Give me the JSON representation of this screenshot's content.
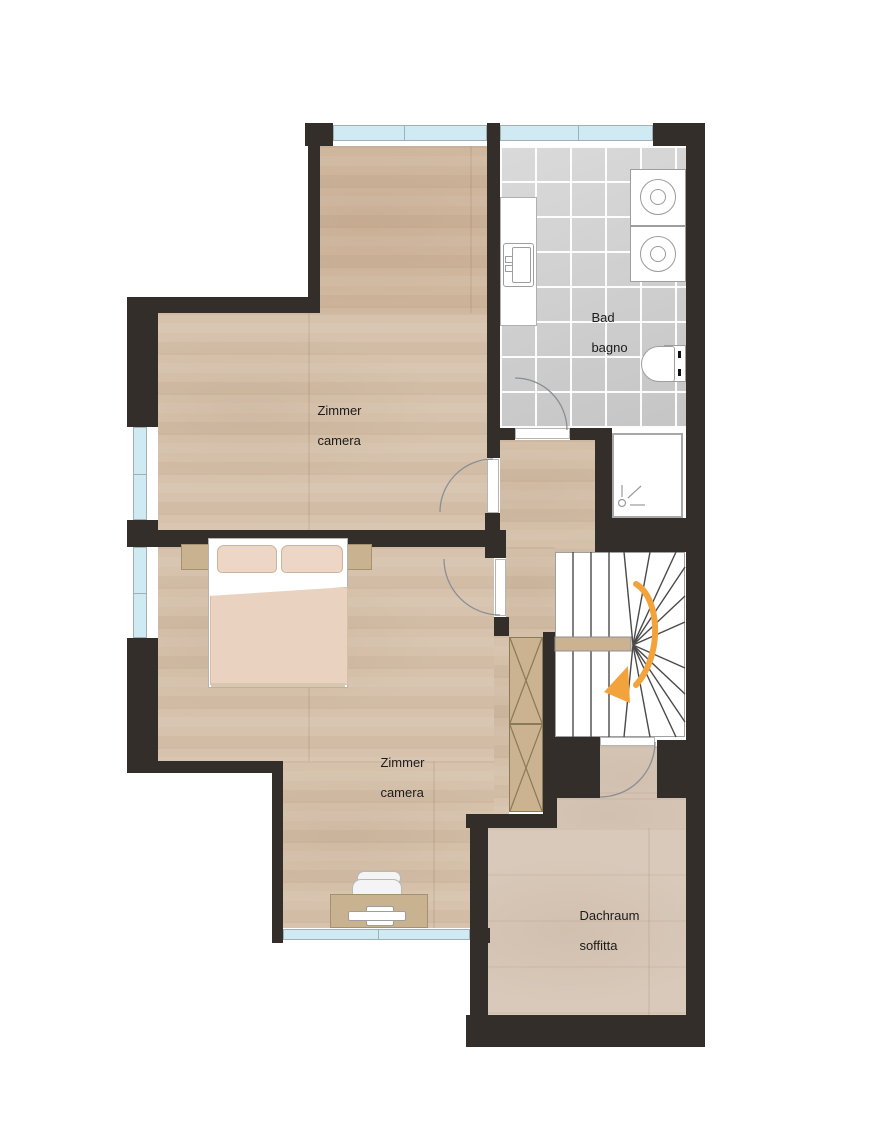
{
  "plan": {
    "type": "floor-plan",
    "floor_labels_bilingual": true
  },
  "rooms": {
    "zimmer1": {
      "line1": "Zimmer",
      "line2": "camera"
    },
    "bad": {
      "line1": "Bad",
      "line2": "bagno"
    },
    "zimmer2": {
      "line1": "Zimmer",
      "line2": "camera"
    },
    "dachraum": {
      "line1": "Dachraum",
      "line2": "soffitta"
    }
  },
  "palette": {
    "wall": "#342e2b",
    "wood_floor": "#d7c3ad",
    "tile_floor": "#cdcdcd",
    "window_glass": "#cfeaf2",
    "stair_arrow_accent": "#f2a33c",
    "furniture_tan": "#c9b28f",
    "bed_textile": "#e9d2c0",
    "label_text": "#1b1b1b"
  },
  "fixtures": {
    "stairs": "winder-staircase",
    "stairs_arrow": "curved-direction-arrow",
    "bath_items": [
      "vanity-sink",
      "washer",
      "washer",
      "toilet",
      "shower"
    ],
    "bedroom_items": [
      "double-bed",
      "nightstand",
      "nightstand",
      "wardrobe",
      "desk",
      "office-chair"
    ]
  }
}
